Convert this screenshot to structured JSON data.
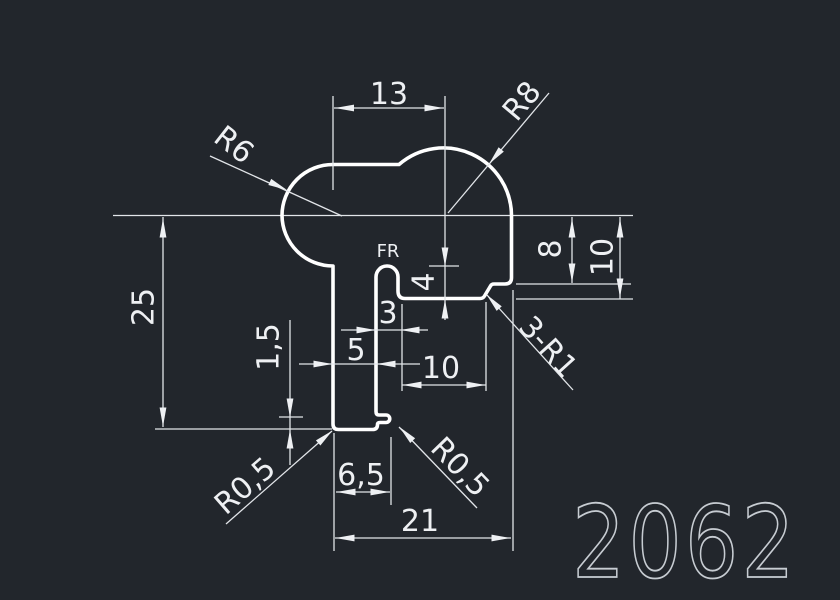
{
  "drawing": {
    "part_number": "2062",
    "labels": {
      "dim_13": "13",
      "rad_r8": "R8",
      "rad_r6": "R6",
      "dim_25": "25",
      "slot_fr": "FR",
      "dim_4": "4",
      "dim_3": "3",
      "dim_5": "5",
      "dim_10_bottom": "10",
      "dim_8": "8",
      "dim_10_right": "10",
      "fillet_3r1": "3-R1",
      "dim_1_5": "1,5",
      "rad_r05_left": "R0,5",
      "rad_r05_right": "R0,5",
      "dim_6_5": "6,5",
      "dim_21": "21"
    },
    "colors": {
      "background": "#22262c",
      "line": "#eef0f3",
      "profile": "#ffffff",
      "part_number_color": "#c7ccd2"
    }
  }
}
